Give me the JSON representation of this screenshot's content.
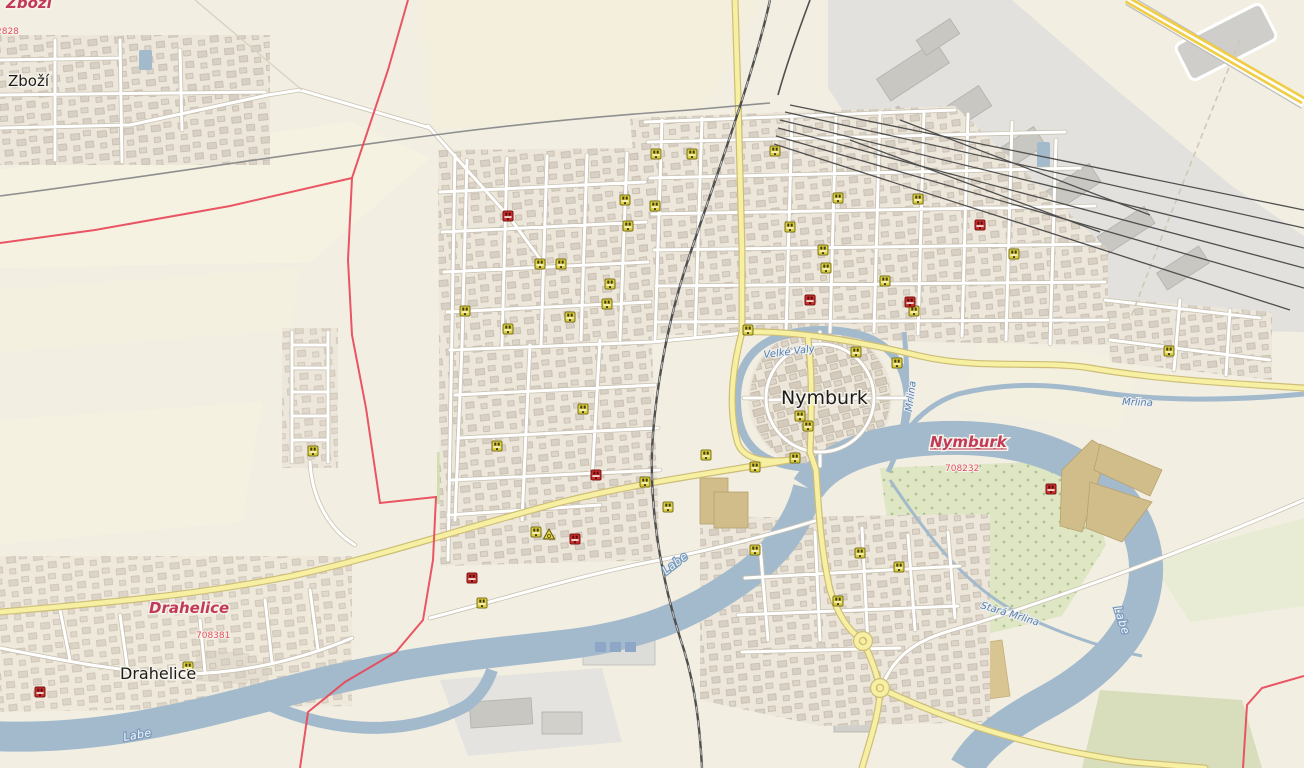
{
  "map": {
    "colors": {
      "land": "#f2efe2",
      "water": "#a3bacd",
      "building": "#d8d0c4",
      "industrial_zone": "#e2e1dd",
      "industrial_building": "#c9c7c2",
      "park": "#dfe6c3",
      "pitch": "#c8dfa0",
      "allotment": "#d9c592",
      "khaki_building": "#d0bd8a",
      "road_yellow": "#f7f0a2",
      "motorway_yellow": "#f0cd45",
      "boundary_red": "#e84858",
      "admin_label_red": "#c23a58",
      "poi_yellow": "#ddcf3e",
      "poi_red": "#c92f2f"
    },
    "labels": [
      {
        "id": "admin-label-zbozi",
        "text": "Zboží",
        "x": 6,
        "y": 8,
        "cls": "lbl-admin"
      },
      {
        "id": "admin-code-2828",
        "text": "2828",
        "x": -4,
        "y": 34,
        "cls": "lbl-code"
      },
      {
        "id": "town-label-zbozi",
        "text": "Zboží",
        "x": 8,
        "y": 86,
        "cls": "lbl-town-sm"
      },
      {
        "id": "city-label-nymburk",
        "text": "Nymburk",
        "x": 781,
        "y": 404,
        "cls": "lbl-city"
      },
      {
        "id": "admin-label-nymburk",
        "text": "Nymburk",
        "x": 930,
        "y": 447,
        "cls": "lbl-admin lbl-admin-u"
      },
      {
        "id": "admin-code-708232",
        "text": "708232",
        "x": 945,
        "y": 471,
        "cls": "lbl-code"
      },
      {
        "id": "admin-label-drahelice",
        "text": "Drahelice",
        "x": 149,
        "y": 613,
        "cls": "lbl-admin",
        "size": 14
      },
      {
        "id": "admin-code-708381",
        "text": "708381",
        "x": 196,
        "y": 638,
        "cls": "lbl-code"
      },
      {
        "id": "town-label-drahelice",
        "text": "Drahelice",
        "x": 120,
        "y": 679,
        "cls": "lbl-town"
      },
      {
        "id": "river-label-labe-1",
        "text": "Labe",
        "x": 666,
        "y": 575,
        "cls": "lbl-river",
        "rotate": -38
      },
      {
        "id": "river-label-labe-2",
        "text": "Labe",
        "x": 124,
        "y": 741,
        "cls": "lbl-river",
        "rotate": -10
      },
      {
        "id": "river-label-labe-3",
        "text": "Labe",
        "x": 1114,
        "y": 608,
        "cls": "lbl-river",
        "rotate": 72
      },
      {
        "id": "stream-label-mrlina",
        "text": "Mrlina",
        "x": 1122,
        "y": 405,
        "cls": "lbl-stream",
        "rotate": 2
      },
      {
        "id": "stream-label-velke-valy",
        "text": "Velké Valy",
        "x": 764,
        "y": 358,
        "cls": "lbl-stream",
        "rotate": -7
      },
      {
        "id": "stream-label-mrlina-channel",
        "text": "Mrlina",
        "x": 912,
        "y": 412,
        "cls": "lbl-stream",
        "rotate": -83
      },
      {
        "id": "stream-label-stara-mrlina",
        "text": "Stará Mrlina",
        "x": 980,
        "y": 608,
        "cls": "lbl-stream",
        "rotate": 17
      }
    ],
    "markers": {
      "yellow": [
        [
          656,
          154
        ],
        [
          692,
          154
        ],
        [
          775,
          151
        ],
        [
          838,
          198
        ],
        [
          918,
          199
        ],
        [
          625,
          200
        ],
        [
          655,
          206
        ],
        [
          628,
          226
        ],
        [
          790,
          227
        ],
        [
          540,
          264
        ],
        [
          561,
          264
        ],
        [
          823,
          250
        ],
        [
          826,
          268
        ],
        [
          885,
          281
        ],
        [
          610,
          284
        ],
        [
          914,
          311
        ],
        [
          607,
          304
        ],
        [
          570,
          317
        ],
        [
          465,
          311
        ],
        [
          508,
          329
        ],
        [
          1014,
          254
        ],
        [
          1169,
          351
        ],
        [
          856,
          352
        ],
        [
          897,
          363
        ],
        [
          800,
          416
        ],
        [
          808,
          426
        ],
        [
          706,
          455
        ],
        [
          755,
          467
        ],
        [
          795,
          458
        ],
        [
          313,
          451
        ],
        [
          497,
          446
        ],
        [
          583,
          409
        ],
        [
          645,
          482
        ],
        [
          668,
          507
        ],
        [
          536,
          532
        ],
        [
          482,
          603
        ],
        [
          755,
          550
        ],
        [
          860,
          553
        ],
        [
          838,
          601
        ],
        [
          899,
          567
        ],
        [
          748,
          330
        ],
        [
          188,
          667
        ]
      ],
      "red": [
        [
          508,
          216
        ],
        [
          980,
          225
        ],
        [
          810,
          300
        ],
        [
          910,
          302
        ],
        [
          596,
          475
        ],
        [
          575,
          539
        ],
        [
          472,
          578
        ],
        [
          1051,
          489
        ],
        [
          40,
          692
        ]
      ],
      "recycling": [
        [
          549,
          535
        ]
      ]
    },
    "roundabouts": [
      [
        863,
        641
      ],
      [
        880,
        688
      ]
    ]
  }
}
